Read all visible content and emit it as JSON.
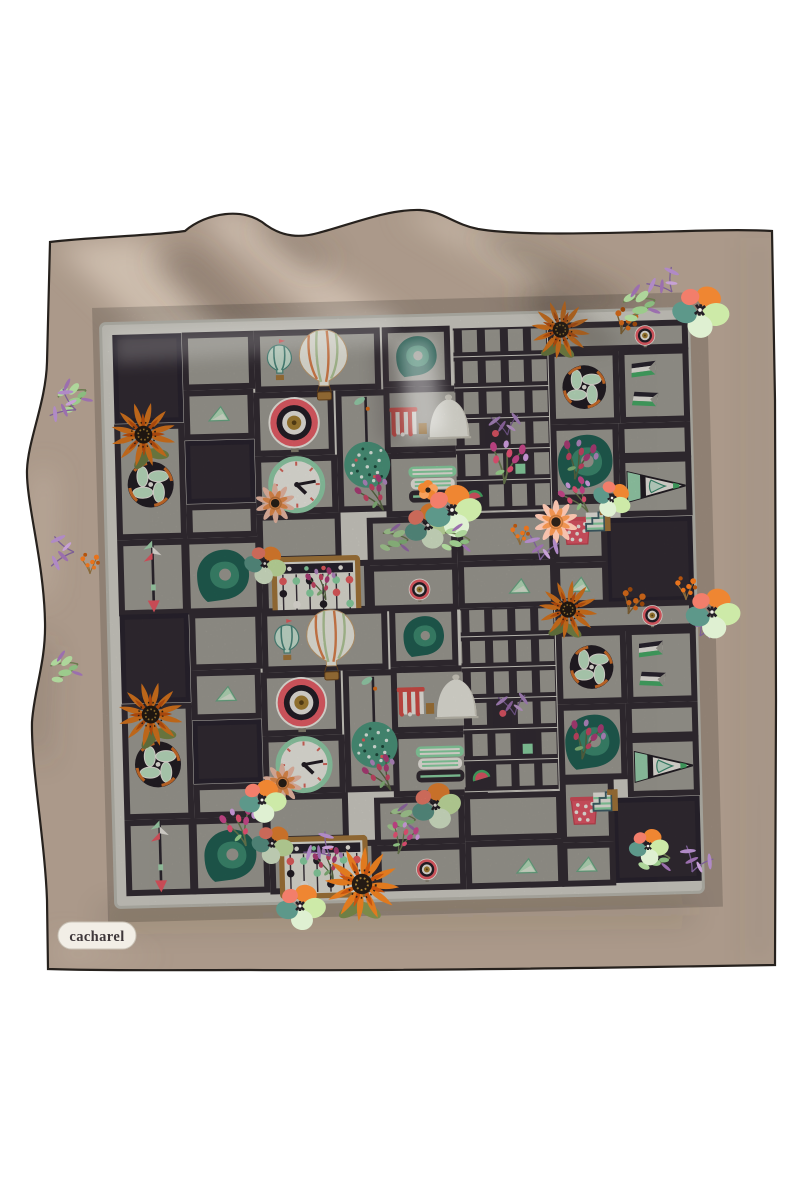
{
  "page": {
    "background": "#ffffff",
    "type": "product-photo"
  },
  "product": {
    "brand": "Cacharel",
    "item": "printed silk scarf, taupe with shadow-box motif print",
    "logo_badge": {
      "text": "cacharel",
      "bg": "#f2eee6",
      "text_color": "#3f383b"
    },
    "colors": {
      "scarf_base": "#ab998a",
      "scarf_highlight": "#e2d2c0",
      "scarf_shadow": "#5e5044",
      "hem_line": "#26211d",
      "print_frame": "#d8d6cd",
      "cell_gray": "#a5a29a",
      "cell_dark": "#342d35",
      "teal": "#226355",
      "mint": "#8fd9a8",
      "orange": "#e07a1f",
      "coral": "#ee5f62",
      "magenta": "#b5407d",
      "lilac": "#bd8fcb",
      "peach": "#f6c2ad",
      "wood": "#a97b3c",
      "ink": "#241f26",
      "print_white": "#f2efe7"
    }
  },
  "print": {
    "motifs": [
      "hot-air-balloon",
      "small-balloon",
      "bullseye-target",
      "wall-clock",
      "topiary-tree",
      "teal-comma-scroll",
      "pinwheel",
      "arrow",
      "pennant-flag",
      "striped-cone",
      "abacus",
      "cloche-and-awning",
      "striped-towels",
      "polka-dot-cup",
      "zigzag-block",
      "watermelon-slice",
      "mint-triangle",
      "sunflower",
      "pansy",
      "peach-daisy",
      "magenta-spray",
      "orange-spray",
      "lilac-spray",
      "leafy-sprig",
      "poppy"
    ]
  }
}
